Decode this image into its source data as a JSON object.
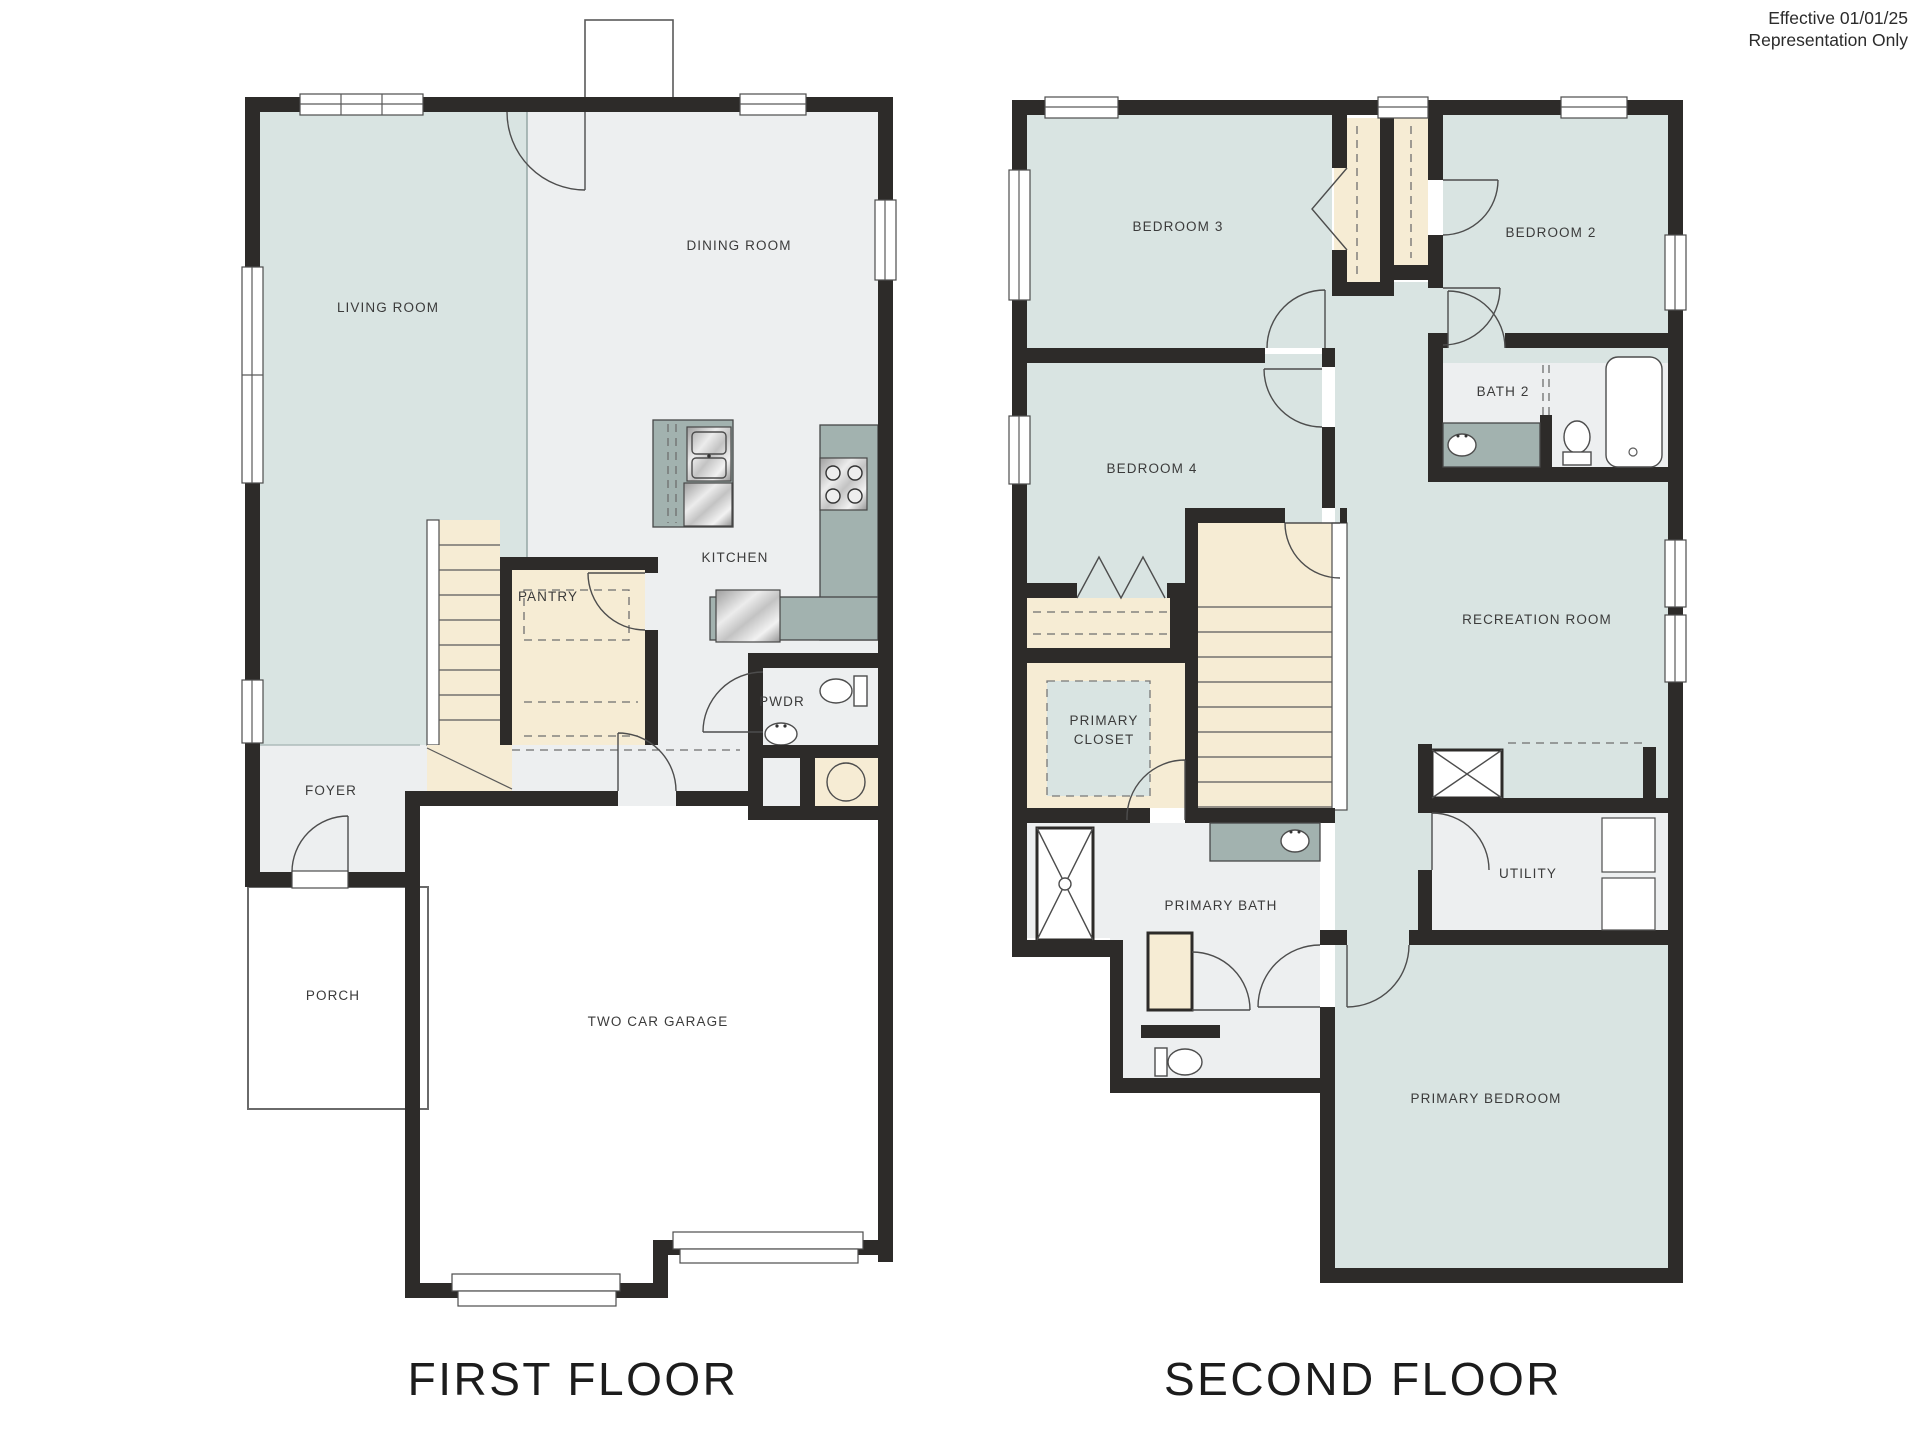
{
  "disclaimer": {
    "line1": "Effective 01/01/25",
    "line2": "Representation Only"
  },
  "floors": [
    {
      "title": "FIRST FLOOR",
      "rooms": {
        "living": "LIVING ROOM",
        "dining": "DINING ROOM",
        "kitchen": "KITCHEN",
        "pantry": "PANTRY",
        "powder": "PWDR",
        "foyer": "FOYER",
        "porch": "PORCH",
        "garage": "TWO CAR GARAGE"
      }
    },
    {
      "title": "SECOND FLOOR",
      "rooms": {
        "bedroom3": "BEDROOM 3",
        "bedroom2": "BEDROOM 2",
        "bedroom4": "BEDROOM 4",
        "bath2": "BATH 2",
        "recreation": "RECREATION ROOM",
        "primary_closet_line1": "PRIMARY",
        "primary_closet_line2": "CLOSET",
        "primary_bath": "PRIMARY BATH",
        "utility": "UTILITY",
        "primary_bedroom": "PRIMARY BEDROOM"
      }
    }
  ],
  "colors": {
    "wall": "#2d2b29",
    "room_teal": "#d9e4e2",
    "room_gray": "#edeff0",
    "closet_beige": "#f6ecd4",
    "counter": "#a2b2af",
    "background": "#ffffff",
    "label_text": "#3b3b3b"
  }
}
